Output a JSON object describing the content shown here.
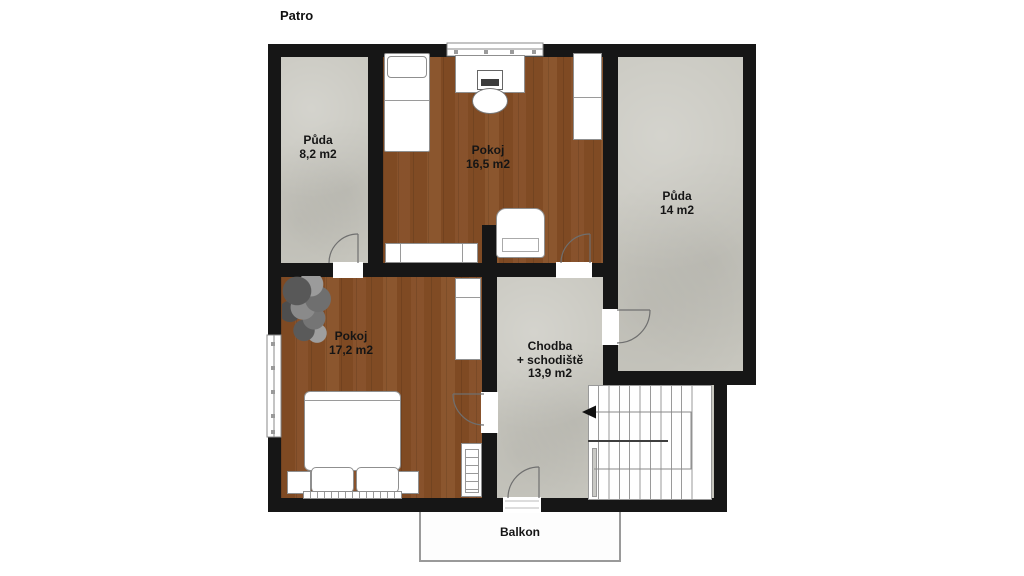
{
  "title": "Patro",
  "rooms": {
    "puda_small": {
      "name": "Půda",
      "area": "8,2 m2"
    },
    "pokoj_top": {
      "name": "Pokoj",
      "area": "16,5 m2"
    },
    "puda_large": {
      "name": "Půda",
      "area": "14 m2"
    },
    "pokoj_bottom": {
      "name": "Pokoj",
      "area": "17,2 m2"
    },
    "chodba": {
      "name": "Chodba",
      "sub": "+ schodiště",
      "area": "13,9 m2"
    },
    "balkon": {
      "name": "Balkon"
    }
  },
  "colors": {
    "wall": "#161616",
    "wood_floor": "#b78d63",
    "concrete_floor": "#c8c7bf",
    "background": "#ffffff",
    "furniture": "#ffffff",
    "line": "#8f8f8f"
  }
}
